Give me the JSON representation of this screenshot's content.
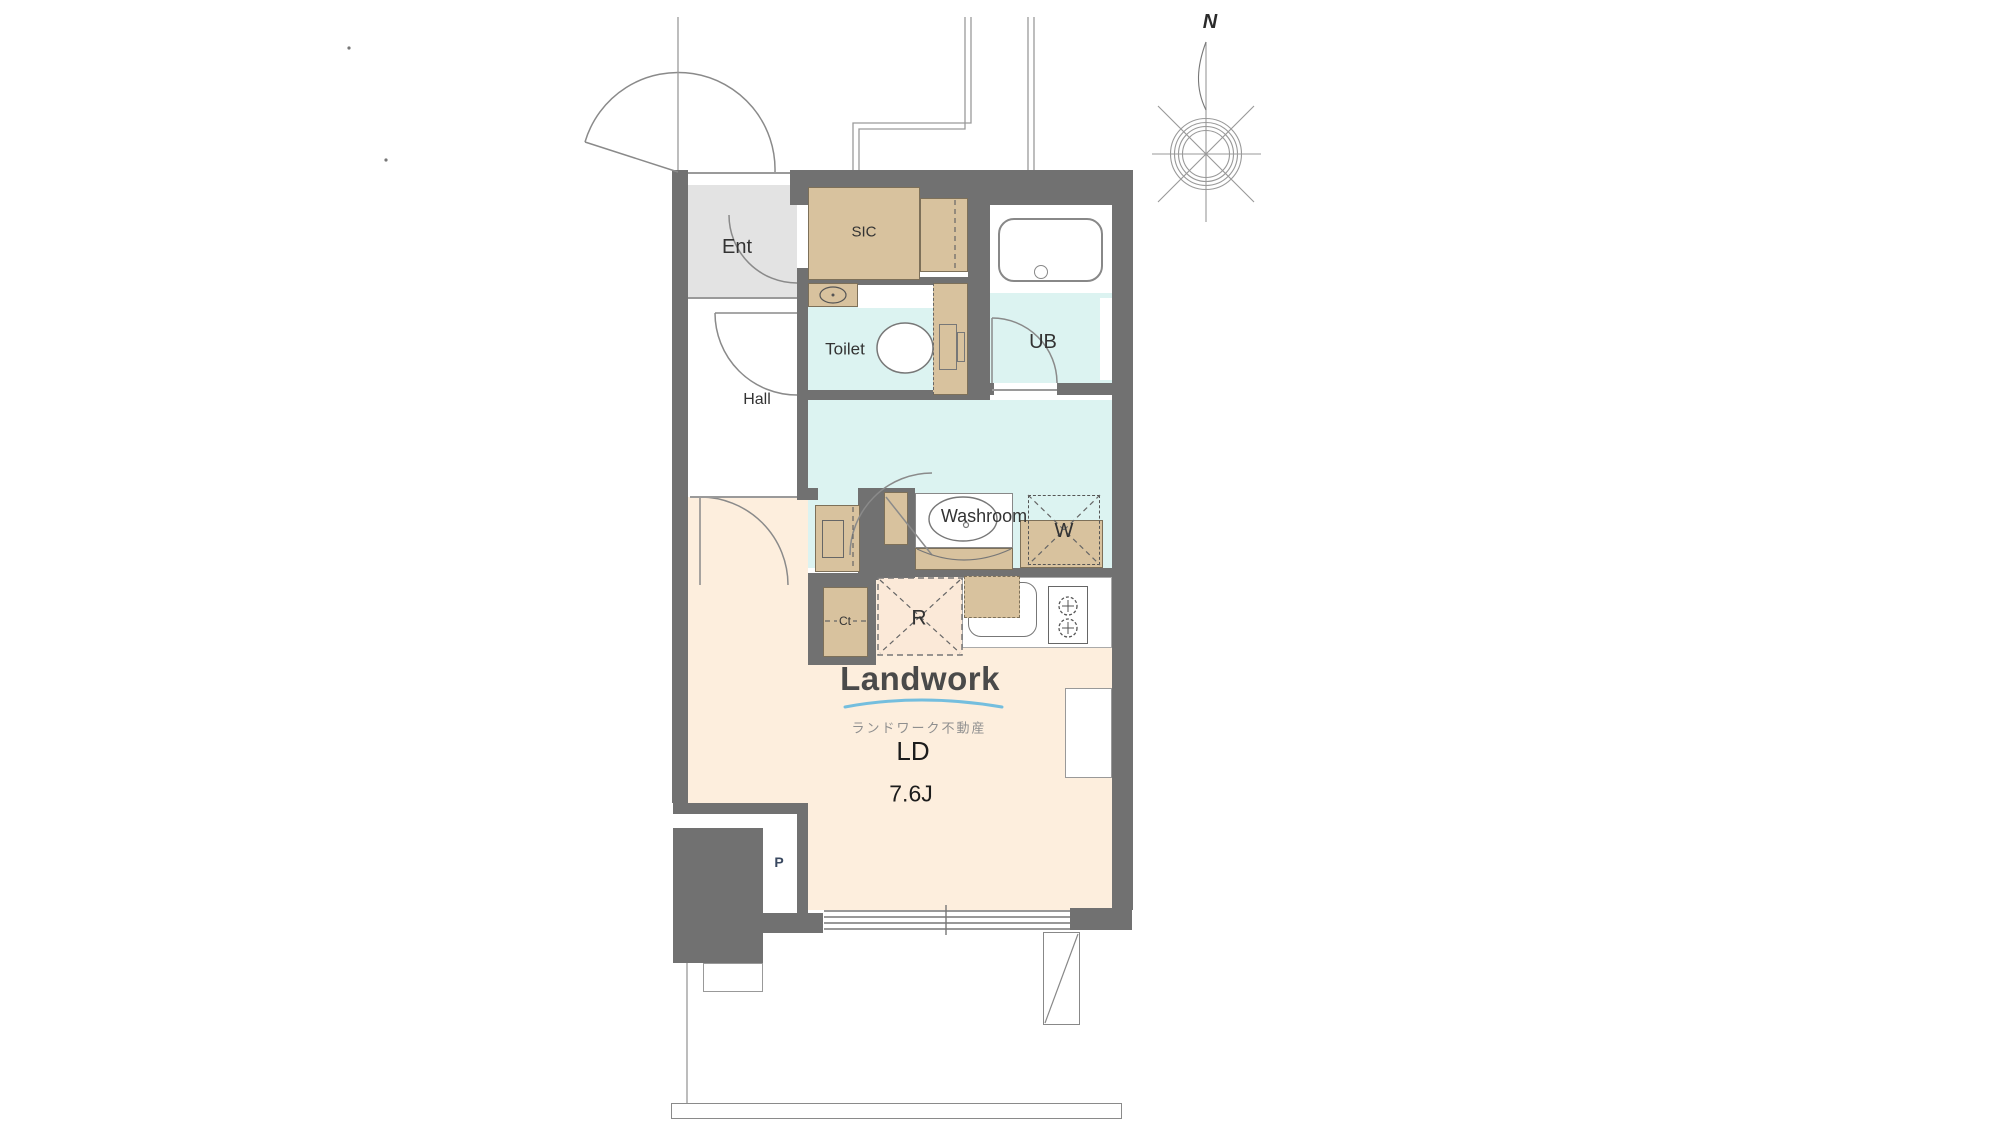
{
  "colors": {
    "page-bg": "#ffffff",
    "wall": "#717171",
    "floor-ent": "#e3e3e3",
    "floor-wet": "#dcf3f1",
    "floor-ld": "#fdeedd",
    "fx-tan": "#d8c29e",
    "fx-border": "#7d7059",
    "fridge-fill": "#fbe9d8",
    "line": "#8a8a8a",
    "label": "#333333",
    "label-blue": "#3a4961",
    "logo-gray": "#4a4a4a",
    "logo-sub": "#8f8f8f",
    "logo-blue": "#74bede"
  },
  "labels": {
    "ent": "Ent",
    "sic": "SIC",
    "toilet": "Toilet",
    "ub": "UB",
    "hall": "Hall",
    "washroom": "Washroom",
    "washer": "W",
    "closet": "Ct",
    "refrigerator": "R",
    "pipe": "P",
    "living": "LD",
    "living_size": "7.6J",
    "north": "N"
  },
  "logo": {
    "brand": "Landwork",
    "company": "ランドワーク不動産"
  }
}
